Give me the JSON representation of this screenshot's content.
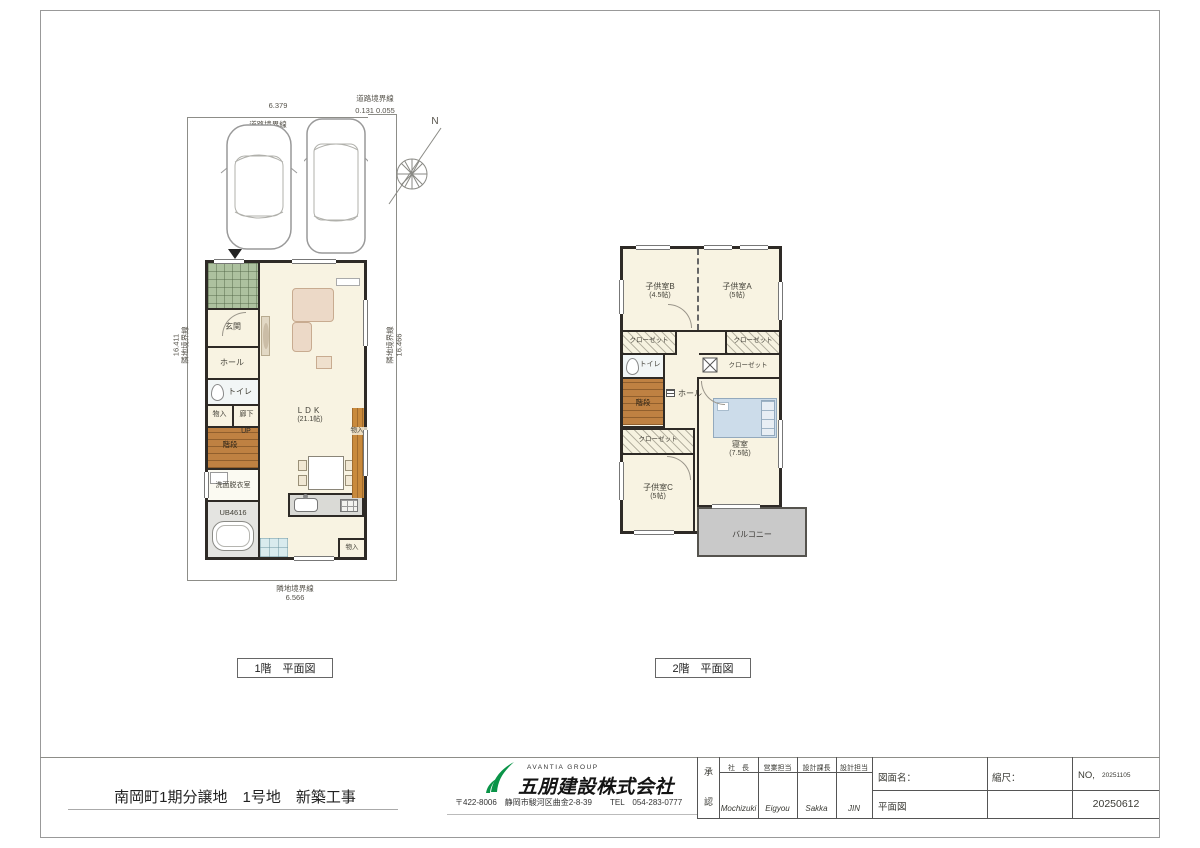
{
  "site": {
    "road_label_top": "道路境界線",
    "road_label_right": "道路境界線",
    "dim_top": "6.379",
    "dim_corner": "0.131 0.055",
    "left_boundary": "隣地境界線",
    "dim_left": "16.411",
    "right_boundary": "隣地境界線",
    "dim_right": "16.466",
    "bottom_boundary": "隣地境界線",
    "dim_bottom": "6.566",
    "compass_north": "N"
  },
  "floor1": {
    "caption": "1階　平面図",
    "genkan": "玄関",
    "hall": "ホール",
    "toilet": "トイレ",
    "storage_hall": "物入",
    "corridor": "廊下",
    "up": "UP",
    "stairs": "階段",
    "washroom": "洗面脱衣室",
    "bath": "UB4616",
    "ldk_name": "LDK",
    "ldk_size": "(21.1帖)",
    "storage_side": "物入",
    "storage_bottom": "物入"
  },
  "floor2": {
    "caption": "2階　平面図",
    "kids_b_name": "子供室B",
    "kids_b_size": "(4.5帖)",
    "kids_a_name": "子供室A",
    "kids_a_size": "(5帖)",
    "closet_b": "クローゼット",
    "closet_a": "クローゼット",
    "toilet": "トイレ",
    "hall": "ホール",
    "stairs": "階段",
    "wic": "クローゼット",
    "closet_c": "クローゼット",
    "bedroom_name": "寝室",
    "bedroom_size": "(7.5帖)",
    "kids_c_name": "子供室C",
    "kids_c_size": "(5帖)",
    "balcony": "バルコニー"
  },
  "title_block": {
    "project": "南岡町1期分譲地　1号地　新築工事",
    "group": "AVANTIA GROUP",
    "company": "五朋建設株式会社",
    "address": "〒422-8006　静岡市駿河区曲金2-8-39",
    "tel": "TEL　054-283-0777",
    "approval_1": "承",
    "approval_2": "認",
    "roles": [
      {
        "label": "社　長",
        "value": "Mochizuki"
      },
      {
        "label": "営業担当",
        "value": "Eigyou"
      },
      {
        "label": "設計課長",
        "value": "Sakka"
      },
      {
        "label": "設計担当",
        "value": "JIN"
      }
    ],
    "drawing_name_label": "図面名：",
    "drawing_name": "平面図",
    "scale_label": "縮尺：",
    "no_label": "NO,",
    "no_value": "20251105",
    "date": "20250612"
  },
  "colors": {
    "logo_green": "#0a9448",
    "wall": "#2e2a26",
    "floor": "#f8f3e2",
    "porch_green": "#adc19f",
    "wood": "#bf8142",
    "balcony_gray": "#c9c9c9"
  }
}
